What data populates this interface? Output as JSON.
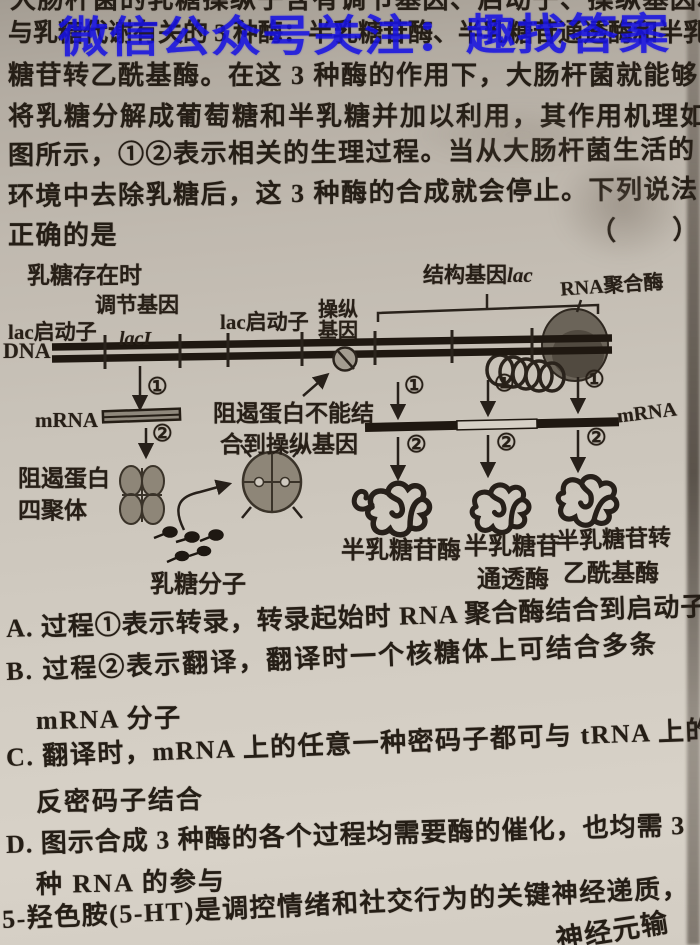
{
  "colors": {
    "watermark_blue": "#1712e2",
    "ink": "#251e16",
    "paper": "#cac4ba",
    "diagram_gray": "#8e8678"
  },
  "watermark": {
    "text": "微信公众号关注：趣找答案"
  },
  "intro": {
    "cropped_top": "大肠杆菌的乳糖操纵子含有调节基因、启动子、操纵基因和",
    "line2": "与乳糖代谢有关的 3 种酶：半乳糖苷酶、半乳糖苷通透酶和半乳",
    "line3": "糖苷转乙酰基酶。在这 3 种酶的作用下，大肠杆菌就能够",
    "line4": "将乳糖分解成葡萄糖和半乳糖并加以利用，其作用机理如",
    "line5": "图所示，①②表示相关的生理过程。当从大肠杆菌生活的",
    "line6": "环境中去除乳糖后，这 3 种酶的合成就会停止。下列说法",
    "line7": "正确的是",
    "brackets": "（　　）"
  },
  "diagram": {
    "condition": "乳糖存在时",
    "regulatory_gene": "调节基因",
    "promoter_left": "lac启动子",
    "lac_i": "lacI",
    "promoter_mid": "lac启动子",
    "operator_l1": "操纵",
    "operator_l2": "基因",
    "structural_gene": "结构基因",
    "structural_gene_suffix": "lac",
    "rna_polymerase": "RNA聚合酶",
    "dna": "DNA",
    "mrna_left": "mRNA",
    "mrna_right": "mRNA",
    "step1": "①",
    "step2": "②",
    "note_l1": "阻遏蛋白不能结",
    "note_l2": "合到操纵基因",
    "repressor_l1": "阻遏蛋白",
    "repressor_l2": "四聚体",
    "lactose_label": "乳糖分子",
    "enzyme1": "半乳糖苷酶",
    "enzyme2_l1": "半乳糖苷",
    "enzyme2_l2": "通透酶",
    "enzyme3_l1": "半乳糖苷转",
    "enzyme3_l2": "乙酰基酶"
  },
  "options": [
    {
      "label": "A.",
      "lines": [
        "过程①表示转录，转录起始时 RNA 聚合酶结合到启动子上"
      ]
    },
    {
      "label": "B.",
      "lines": [
        "过程②表示翻译，翻译时一个核糖体上可结合多条",
        "mRNA 分子"
      ]
    },
    {
      "label": "C.",
      "lines": [
        "翻译时，mRNA 上的任意一种密码子都可与 tRNA 上的",
        "反密码子结合"
      ]
    },
    {
      "label": "D.",
      "lines": [
        "图示合成 3 种酶的各个过程均需要酶的催化，也均需 3",
        "种 RNA 的参与"
      ]
    }
  ],
  "next_question": {
    "text": "5-羟色胺(5-HT)是调控情绪和社交行为的关键神经递质，",
    "fragment": "神经元输"
  }
}
